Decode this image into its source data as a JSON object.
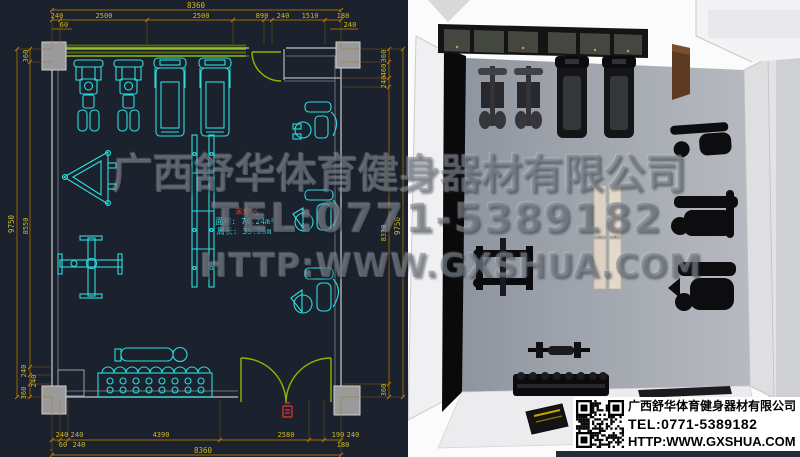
{
  "watermark": {
    "line1": "广西舒华体育健身器材有限公司",
    "line2": "TEL:0771-5389182",
    "line3": "HTTP:WWW.GXSHUA.COM"
  },
  "plan": {
    "room_label": {
      "name": "未命名",
      "area": "面积: 74.24m²",
      "perimeter": "周长: 35.26m"
    },
    "dims": {
      "top_total": "8360",
      "top_segments": [
        "240",
        "2500",
        "2500",
        "890",
        "240",
        "1510",
        "180"
      ],
      "top_sub": [
        "60",
        "240"
      ],
      "bottom_segments": [
        "240",
        "240",
        "4390",
        "2580",
        "190",
        "240"
      ],
      "bottom_sub": [
        "60",
        "240",
        "180"
      ],
      "bottom_total": "8360",
      "left_segments": [
        "360",
        "8550",
        "240",
        "240",
        "360"
      ],
      "left_total": "9750",
      "right_segments": [
        "360",
        "460",
        "240",
        "8330",
        "360"
      ],
      "right_total": "9750"
    }
  },
  "info_card": {
    "company": "广西舒华体育健身器材有限公司",
    "tel": "TEL:0771-5389182",
    "url": "HTTP:WWW.GXSHUA.COM"
  },
  "colors": {
    "cad_background": "#1b222e",
    "cad_equipment_cyan": "#2adede",
    "dimension_line": "#a06a00",
    "dimension_text": "#cdb92a",
    "wall_gray": "#b4b4b4",
    "column_gray": "#9a9a9a",
    "door_green": "#8ab800",
    "marker_red": "#d03030",
    "floor_3d_gray": "#a0a5ae",
    "bench_beige": "#dcd1c3",
    "cabinet_brown": "#5d3a22"
  }
}
